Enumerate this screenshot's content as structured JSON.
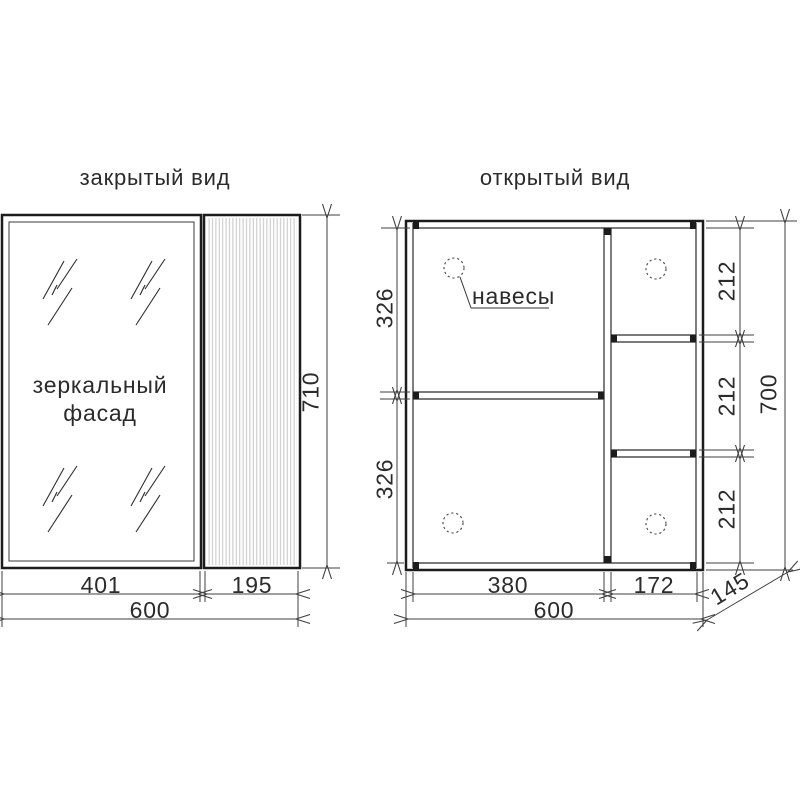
{
  "closed_view": {
    "title": "закрытый вид",
    "mirror_label_line1": "зеркальный",
    "mirror_label_line2": "фасад",
    "dims": {
      "door_width": "401",
      "side_width": "195",
      "total_width": "600",
      "height": "710"
    }
  },
  "open_view": {
    "title": "открытый вид",
    "hinges_label": "навесы",
    "dims": {
      "upper_section_height": "326",
      "lower_section_height": "326",
      "right_cell_top": "212",
      "right_cell_middle": "212",
      "right_cell_bottom": "212",
      "total_height": "700",
      "main_section_width": "380",
      "right_column_width": "172",
      "total_width": "600",
      "depth": "145"
    }
  },
  "colors": {
    "structure_line": "#1c1c1c",
    "dimension_line": "#3f3f3f",
    "stripe": "#c5c5c5",
    "background": "#ffffff"
  }
}
